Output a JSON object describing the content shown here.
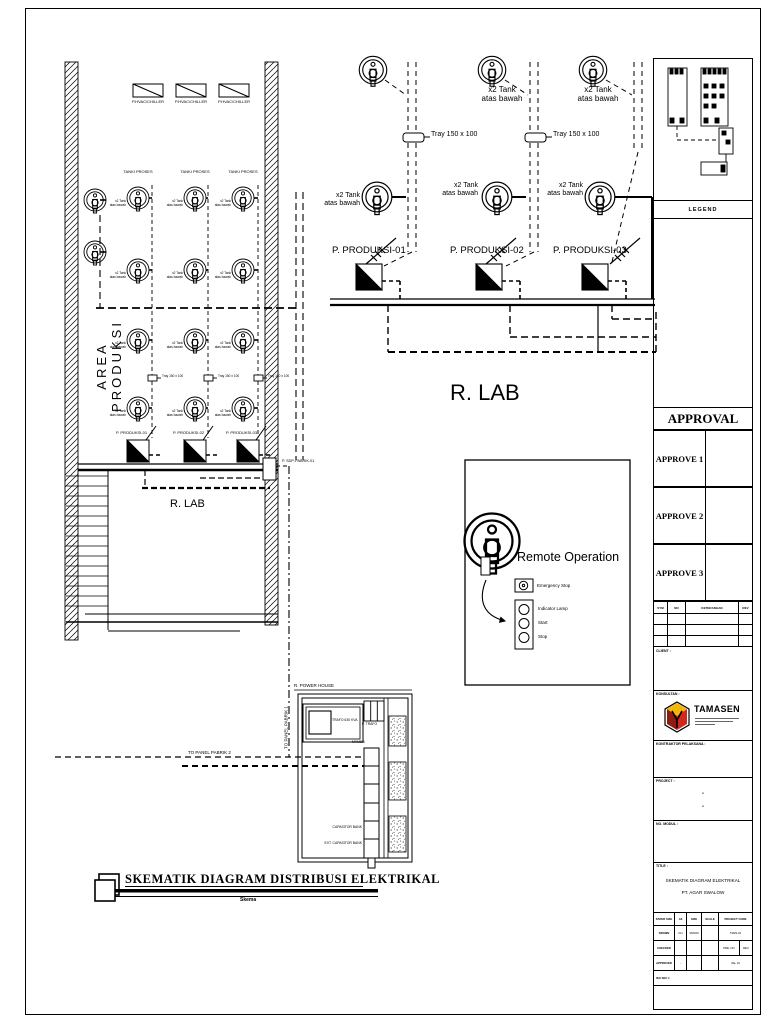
{
  "labels": {
    "hvac": "P.HVAC/CHILLER",
    "tanki_proses": "TANKI PROSES",
    "tank2": "x2 Tank\natas bawah",
    "area_produksi": "AREA PRODUKSI",
    "tray": "Tray 150 x 100",
    "produksi": [
      "P. PRODUKSI-01",
      "P. PRODUKSI-02",
      "P. PRODUKSI-03"
    ],
    "sdp": "P. SDP-PABRIK-01",
    "rlab": "R. LAB",
    "power_house": "R. POWER HOUSE",
    "to_panel_1": "TO PANEL PABRIK 1",
    "to_panel_2": "TO PANEL PABRIK 2",
    "trafo": "TRAFO 630 KVA",
    "p_trafo": "P. TRAFO",
    "mvmdb": "MVMDB",
    "cap_bank": "CAPASITOR BANK",
    "ext_cap_bank": "EXT. CAPASITOR BANK"
  },
  "remote": {
    "title": "Remote Operation",
    "emergency": "Emergency Stop",
    "lamp": "Indicator Lamp",
    "start": "Start",
    "stop": "Stop"
  },
  "footer": {
    "title": "SKEMATIK DIAGRAM DISTRIBUSI ELEKTRIKAL",
    "subtitle": "Skema"
  },
  "titleblock": {
    "legend": "LEGEND",
    "approval": "APPROVAL",
    "approves": [
      "APPROVE 1",
      "APPROVE 2",
      "APPROVE 3"
    ],
    "rev_cols": [
      "SYM",
      "NO",
      "KETERANGAN",
      "REV"
    ],
    "client": "CLIENT :",
    "konsultan": "KONSULTAN :",
    "brand": "TAMASEN",
    "kontraktor": "KONTRAKTOR PELAKSANA :",
    "project": "PROJECT :",
    "project_dash": "-",
    "no_modul": "NO. MODUL :",
    "title_label": "TITLE :",
    "doc_title": [
      "SKEMATIK DIAGRAM ELEKTRIKAL",
      "PT. AGAR SWALOW"
    ],
    "table": {
      "paper_size": "PAPER SIZE",
      "a3": "A3",
      "size": "SIZE",
      "scale": "SCALE",
      "project_code": "PROJECT CODE",
      "drawn": "DRAWN",
      "drawn_by": "2x1",
      "date": "30/9/20",
      "code": "TM29-01",
      "checked": "CHECKED",
      "pre_no": "PRE. NO",
      "rev": "REV",
      "approved": "APPROVED",
      "dash": "-",
      "valid": "VAL.01",
      "iso": "ISO SEC 1"
    }
  },
  "colors": {
    "ink": "#000000",
    "logo_red": "#d22a1a",
    "logo_yellow": "#f2b705",
    "logo_dark": "#8f1c10"
  }
}
